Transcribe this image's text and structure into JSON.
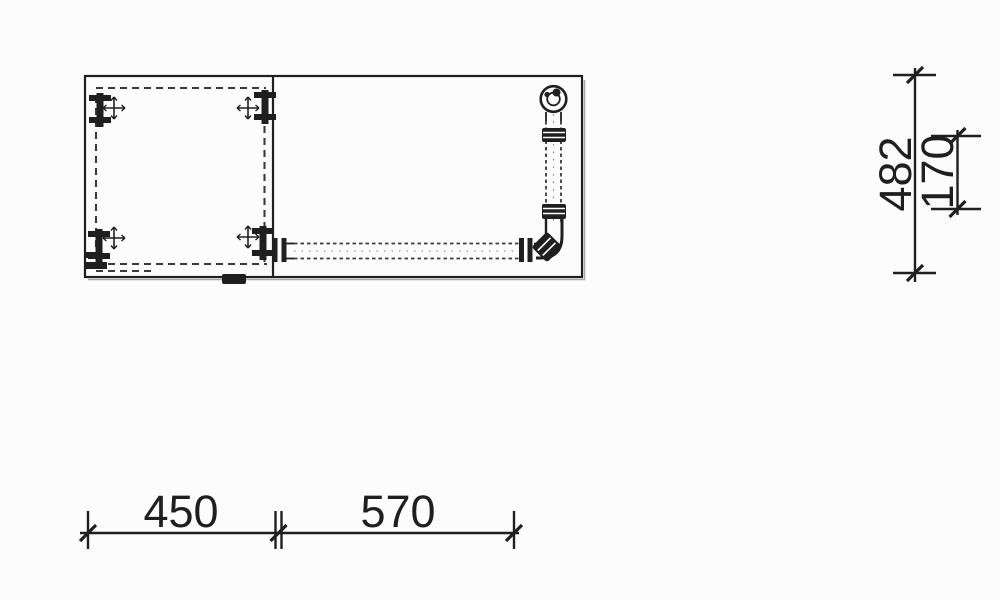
{
  "colors": {
    "ink": "#1f1f1f",
    "paper": "#fcfcfc"
  },
  "dims": {
    "bottom": [
      {
        "value": "450"
      },
      {
        "value": "570"
      }
    ],
    "right": [
      {
        "value": "482"
      },
      {
        "value": "170"
      }
    ]
  }
}
